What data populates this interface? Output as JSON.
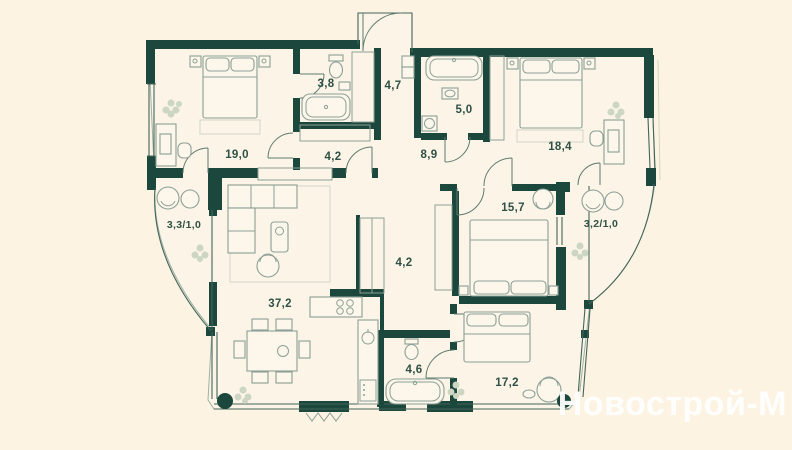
{
  "watermark": {
    "text": "Новострой-М",
    "color": "#ffffff"
  },
  "colors": {
    "background": "#fdf3e3",
    "wall": "#1c473d",
    "outline": "#43655a",
    "furniture": "#8ba096",
    "label": "#2e5045",
    "plant": "#ccd6c3"
  },
  "rooms": [
    {
      "id": "bedroom-1",
      "label": "19,0"
    },
    {
      "id": "bathroom-1",
      "label": "3,8"
    },
    {
      "id": "entry-hall",
      "label": "4,7"
    },
    {
      "id": "bathroom-2",
      "label": "5,0"
    },
    {
      "id": "bedroom-2",
      "label": "18,4"
    },
    {
      "id": "hallway-top",
      "label": "4,2"
    },
    {
      "id": "hallway-center",
      "label": "8,9"
    },
    {
      "id": "balcony-left",
      "label": "3,3/1,0"
    },
    {
      "id": "bedroom-3",
      "label": "15,7"
    },
    {
      "id": "balcony-right",
      "label": "3,2/1,0"
    },
    {
      "id": "corridor",
      "label": "4,2"
    },
    {
      "id": "living-room",
      "label": "37,2"
    },
    {
      "id": "bathroom-3",
      "label": "4,6"
    },
    {
      "id": "bedroom-4",
      "label": "17,2"
    }
  ]
}
